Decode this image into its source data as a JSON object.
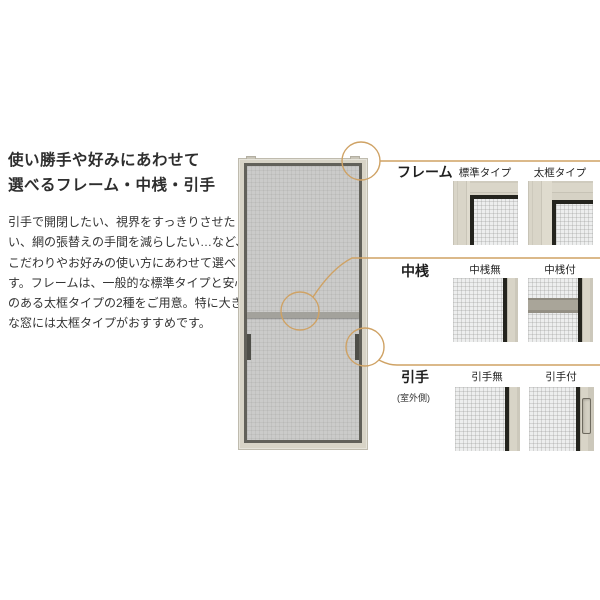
{
  "intro": {
    "heading_line1": "使い勝手や好みにあわせて",
    "heading_line2": "選べるフレーム・中桟・引手",
    "body_line1": "引手で開閉したい、視界をすっきりさせた",
    "body_line2": "い、網の張替えの手間を減らしたい…など、",
    "body_line3": "こだわりやお好みの使い方にあわせて選べま",
    "body_line4": "す。フレームは、一般的な標準タイプと安心感",
    "body_line5": "のある太框タイプの2種をご用意。特に大き",
    "body_line6": "な窓には太框タイプがおすすめです。"
  },
  "rows": {
    "frame": {
      "label": "フレーム",
      "option1": "標準タイプ",
      "option2": "太框タイプ"
    },
    "midrail": {
      "label": "中桟",
      "option1": "中桟無",
      "option2": "中桟付"
    },
    "handle": {
      "label": "引手",
      "note": "(室外側)",
      "option1": "引手無",
      "option2": "引手付"
    }
  },
  "colors": {
    "accent_line": "#cfa264",
    "frame_beige": "#d6d2c5",
    "frame_black": "#24241e",
    "sample_mesh": "#edeeee",
    "door_mesh": "#cbcbca",
    "text": "#333333"
  }
}
